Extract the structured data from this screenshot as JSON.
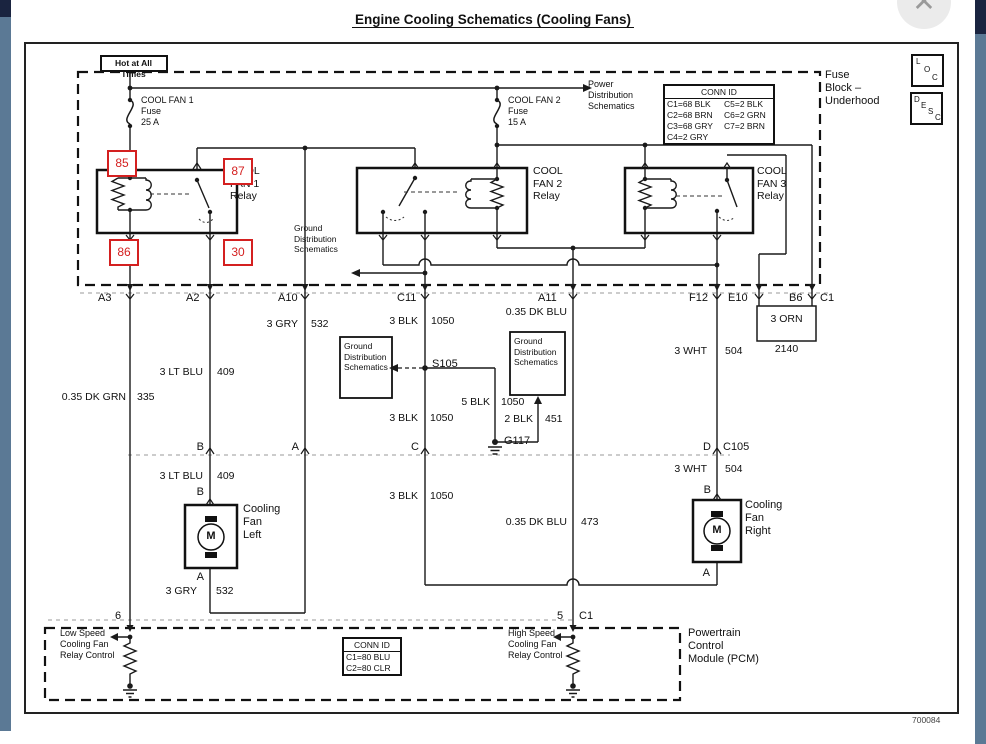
{
  "title": "Engine Cooling Schematics (Cooling Fans)",
  "drawing_number": "700084",
  "chrome": {
    "close_glyph": "✕",
    "loc": [
      "L",
      "O",
      "C"
    ],
    "desc": [
      "D",
      "E",
      "S",
      "C"
    ]
  },
  "fuse_block": {
    "hot_at_all_times": "Hot at All Times",
    "fuse1": "COOL FAN 1\nFuse\n25 A",
    "fuse2": "COOL FAN 2\nFuse\n15 A",
    "power_dist": "Power\nDistribution\nSchematics",
    "block_label": "Fuse\nBlock –\nUnderhood",
    "conn_id": {
      "title": "CONN ID",
      "col1": [
        "C1=68 BLK",
        "C2=68 BRN",
        "C3=68 GRY",
        "C4=2 GRY"
      ],
      "col2": [
        "C5=2 BLK",
        "C6=2 GRN",
        "C7=2 BRN"
      ]
    },
    "relay1": "COOL\nFAN 1\nRelay",
    "relay2": "COOL\nFAN 2\nRelay",
    "relay3": "COOL\nFAN 3\nRelay",
    "pins": {
      "p85": "85",
      "p87": "87",
      "p86": "86",
      "p30": "30"
    },
    "gds_note": "Ground\nDistribution\nSchematics"
  },
  "connector_row1": [
    "A3",
    "A2",
    "A10",
    "C11",
    "A11",
    "F12",
    "E10",
    "B6",
    "C1"
  ],
  "wires": {
    "dk_grn": {
      "name": "0.35 DK GRN",
      "num": "335"
    },
    "lt_blu": {
      "name": "3 LT BLU",
      "num": "409"
    },
    "gry": {
      "name": "3 GRY",
      "num": "532"
    },
    "blk": {
      "name": "3 BLK",
      "num": "1050"
    },
    "blk5": {
      "name": "5 BLK",
      "num": "1050"
    },
    "blk2": {
      "name": "2 BLK",
      "num": "451"
    },
    "dk_blu": {
      "name": "0.35 DK BLU",
      "num": "473"
    },
    "wht": {
      "name": "3 WHT",
      "num": "504"
    },
    "orn": {
      "name": "3 ORN",
      "num": "2140"
    }
  },
  "nodes": {
    "s105": "S105",
    "g117": "G117"
  },
  "gds_box": "Ground\nDistribution\nSchematics",
  "row2": {
    "b": "B",
    "a": "A",
    "c": "C",
    "d": "D",
    "c105": "C105"
  },
  "motor_left": {
    "label": "Cooling\nFan\nLeft",
    "m": "M",
    "b": "B",
    "a": "A"
  },
  "motor_right": {
    "label": "Cooling\nFan\nRight",
    "m": "M",
    "b": "B",
    "a": "A"
  },
  "pcm": {
    "pin6": "6",
    "pin5": "5",
    "c1": "C1",
    "low": "Low Speed\nCooling Fan\nRelay Control",
    "high": "High Speed\nCooling Fan\nRelay Control",
    "conn_id": {
      "title": "CONN ID",
      "rows": [
        "C1=80 BLU",
        "C2=80 CLR"
      ]
    },
    "label": "Powertrain\nControl\nModule (PCM)"
  }
}
